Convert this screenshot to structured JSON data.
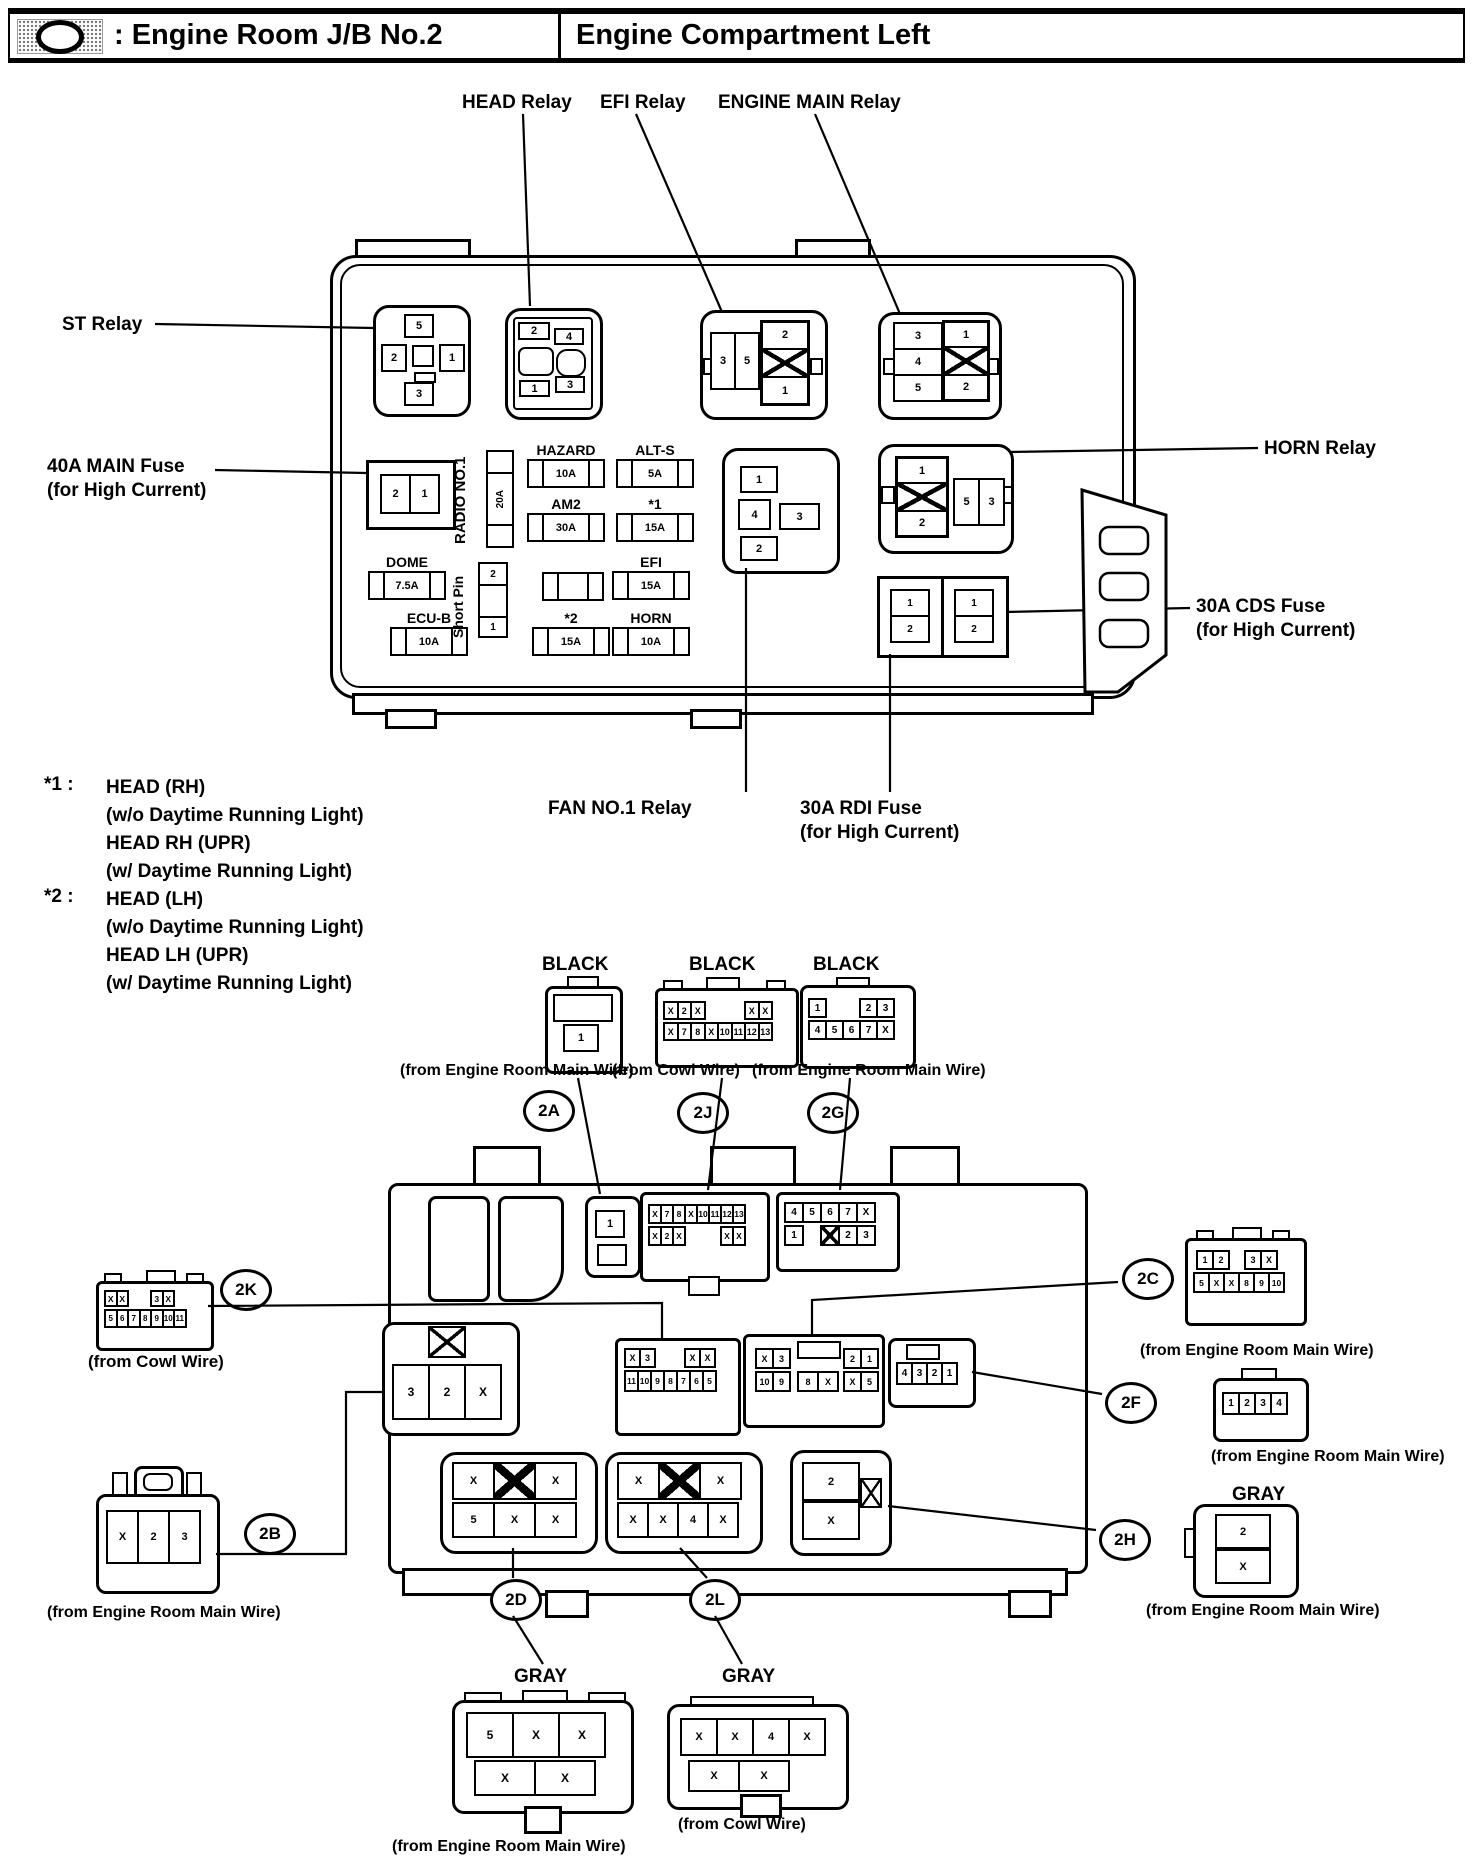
{
  "header": {
    "icon_name": "junction-block-icon",
    "left_title": ": Engine Room J/B No.2",
    "right_title": "Engine Compartment Left"
  },
  "labels": {
    "head_relay": "HEAD Relay",
    "efi_relay": "EFI Relay",
    "engine_main_relay": "ENGINE MAIN Relay",
    "st_relay": "ST Relay",
    "main_fuse_line1": "40A MAIN Fuse",
    "main_fuse_line2": "(for High Current)",
    "horn_relay": "HORN Relay",
    "cds_fuse_line1": "30A CDS Fuse",
    "cds_fuse_line2": "(for High Current)",
    "fan_relay": "FAN NO.1 Relay",
    "rdi_fuse_line1": "30A RDI Fuse",
    "rdi_fuse_line2": "(for High Current)"
  },
  "footnotes": [
    {
      "key": "*1 :",
      "lines": [
        "HEAD (RH)",
        "(w/o Daytime Running Light)",
        "HEAD RH (UPR)",
        "(w/ Daytime Running Light)"
      ]
    },
    {
      "key": "*2 :",
      "lines": [
        "HEAD (LH)",
        "(w/o Daytime Running Light)",
        "HEAD LH (UPR)",
        "(w/ Daytime Running Light)"
      ]
    }
  ],
  "relays": {
    "st": {
      "top": "5",
      "left": "2",
      "right": "1",
      "bottom": "3"
    },
    "head": {
      "tl": "2",
      "tr": "4",
      "bl": "1",
      "br": "3"
    },
    "efi": {
      "left": [
        "3",
        "5"
      ],
      "right_top": "2",
      "right_bottom": "1"
    },
    "engine_main": {
      "left": [
        "3",
        "4",
        "5"
      ],
      "right_top": "1",
      "right_bottom": "2"
    },
    "fan": {
      "top": "1",
      "left": "4",
      "right": "3",
      "bottom": "2"
    },
    "horn": {
      "left_top": "1",
      "left_bottom": "2",
      "right": [
        "5",
        "3"
      ]
    }
  },
  "fuses": {
    "main": {
      "pins": [
        "2",
        "1"
      ]
    },
    "radio": {
      "label": "RADIO NO.1",
      "amp": "20A"
    },
    "hazard": {
      "label": "HAZARD",
      "amp": "10A"
    },
    "alt_s": {
      "label": "ALT-S",
      "amp": "5A"
    },
    "am2": {
      "label": "AM2",
      "amp": "30A"
    },
    "star1": {
      "label": "*1",
      "amp": "15A"
    },
    "dome": {
      "label": "DOME",
      "amp": "7.5A"
    },
    "efi": {
      "label": "EFI",
      "amp": "15A"
    },
    "ecu_b": {
      "label": "ECU-B",
      "amp": "10A"
    },
    "short_pin": {
      "label": "Short Pin",
      "top": "2",
      "bottom": "1"
    },
    "star2": {
      "label": "*2",
      "amp": "15A"
    },
    "horn": {
      "label": "HORN",
      "amp": "10A"
    },
    "cds": [
      {
        "top": "1",
        "bottom": "2"
      },
      {
        "top": "1",
        "bottom": "2"
      }
    ]
  },
  "circles": {
    "a": "2A",
    "j": "2J",
    "g": "2G",
    "k": "2K",
    "c": "2C",
    "f": "2F",
    "b": "2B",
    "h": "2H",
    "d": "2D",
    "l": "2L"
  },
  "connectors": {
    "out_2a": {
      "color": "BLACK",
      "pins": [
        "1"
      ],
      "source": "(from Engine Room Main Wire)"
    },
    "out_2j": {
      "color": "BLACK",
      "row1": [
        "X",
        "2",
        "X",
        "",
        "",
        "",
        "X",
        "X"
      ],
      "row2": [
        "X",
        "7",
        "8",
        "X",
        "10",
        "11",
        "12",
        "13"
      ],
      "source": "(from Cowl Wire)"
    },
    "out_2g": {
      "color": "BLACK",
      "row1": [
        "1",
        "",
        "",
        "2",
        "3"
      ],
      "row2": [
        "4",
        "5",
        "6",
        "7",
        "X"
      ],
      "source": "(from Engine Room Main Wire)"
    },
    "out_2k": {
      "row1": [
        "X",
        "X",
        "",
        "",
        "3",
        "X"
      ],
      "row2": [
        "5",
        "6",
        "7",
        "8",
        "9",
        "10",
        "11"
      ],
      "source": "(from Cowl Wire)"
    },
    "out_2b": {
      "pins": [
        "X",
        "2",
        "3"
      ],
      "source": "(from Engine Room Main Wire)"
    },
    "out_2c": {
      "row1": [
        "1",
        "2",
        "",
        "3",
        "X"
      ],
      "row2": [
        "5",
        "X",
        "X",
        "8",
        "9",
        "10"
      ],
      "source": "(from Engine Room Main Wire)"
    },
    "out_2f": {
      "pins": [
        "1",
        "2",
        "3",
        "4"
      ],
      "source": "(from Engine Room Main Wire)"
    },
    "out_2h": {
      "color": "GRAY",
      "top": "2",
      "bottom": "X",
      "source": "(from Engine Room Main Wire)"
    },
    "out_2d": {
      "color": "GRAY",
      "row1": [
        "5",
        "X",
        "X"
      ],
      "row2": [
        "X",
        "X"
      ],
      "source": "(from Engine Room Main Wire)"
    },
    "out_2l": {
      "color": "GRAY",
      "row1": [
        "X",
        "X",
        "4",
        "X"
      ],
      "row2": [
        "X",
        "X"
      ],
      "source": "(from Cowl Wire)"
    },
    "in_2a": {
      "pins": [
        "1"
      ]
    },
    "in_2j": {
      "row1": [
        "X",
        "7",
        "8",
        "X",
        "10",
        "11",
        "12",
        "13"
      ],
      "row2": [
        "X",
        "2",
        "X",
        "",
        "",
        "",
        "X",
        "X"
      ]
    },
    "in_2g": {
      "row1": [
        "4",
        "5",
        "6",
        "7",
        "X"
      ],
      "row2": [
        "1",
        "",
        "#",
        "2",
        "3"
      ]
    },
    "in_2b": {
      "pins": [
        "3",
        "2",
        "X"
      ]
    },
    "in_2k": {
      "row1": [
        "X",
        "3",
        "",
        "",
        "X",
        "X"
      ],
      "row2": [
        "11",
        "10",
        "9",
        "8",
        "7",
        "6",
        "5"
      ]
    },
    "in_2c": {
      "lt": [
        "X",
        "3"
      ],
      "lb": [
        "10",
        "9"
      ],
      "mb": [
        "8",
        "X"
      ],
      "rt": [
        "2",
        "1"
      ],
      "rb": [
        "X",
        "5"
      ]
    },
    "in_2f": {
      "pins": [
        "4",
        "3",
        "2",
        "1"
      ]
    },
    "in_2d": {
      "row1": [
        "X",
        "#",
        "X"
      ],
      "row2": [
        "5",
        "X",
        "X"
      ]
    },
    "in_2l": {
      "row1": [
        "X",
        "#",
        "X"
      ],
      "row2": [
        "X",
        "X",
        "4",
        "X"
      ]
    },
    "in_2h": {
      "top": "2",
      "bottom": "X"
    }
  }
}
